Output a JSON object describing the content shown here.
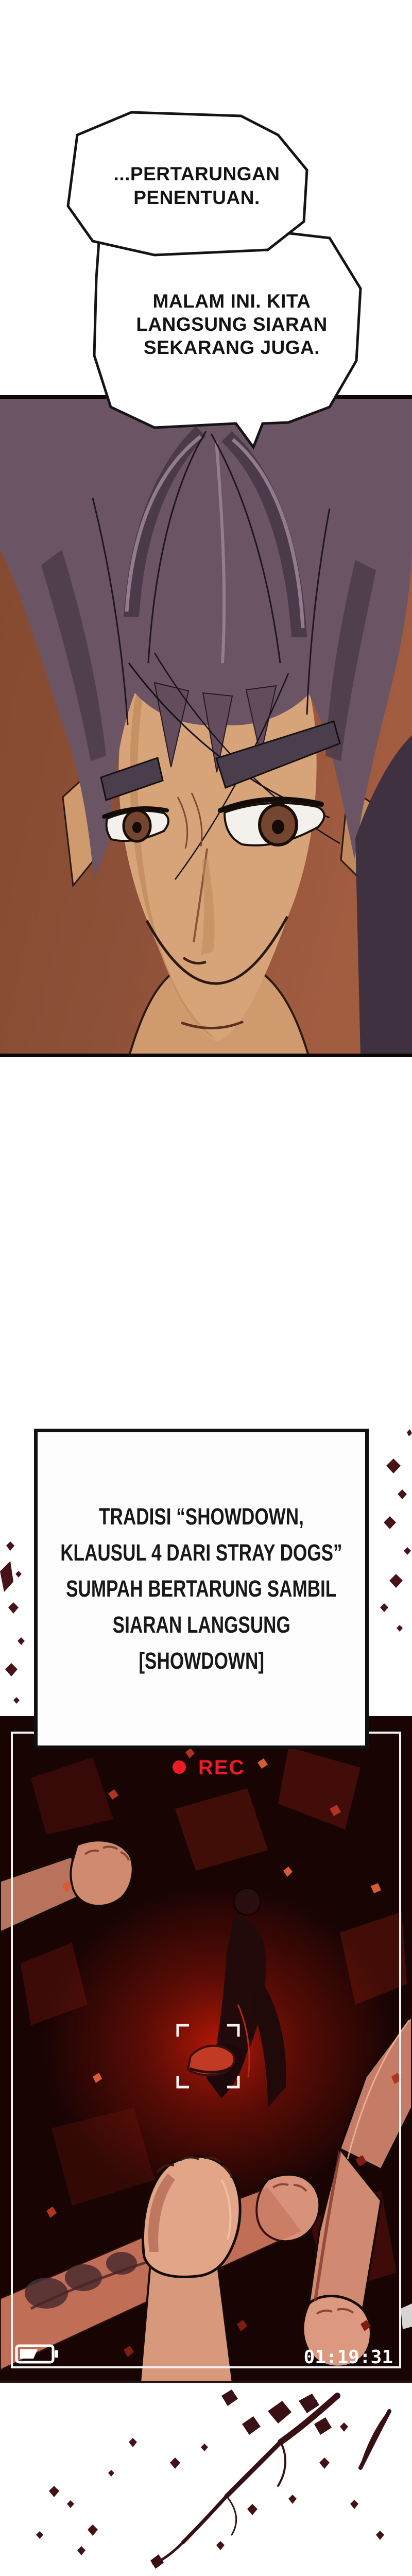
{
  "page": {
    "kind": "comic-page",
    "background": "#ffffff"
  },
  "bubbles": [
    {
      "lines": [
        "...PERTARUNGAN",
        "PENENTUAN."
      ]
    },
    {
      "lines": [
        "MALAM INI. KITA",
        "LANGSUNG SIARAN",
        "SEKARANG JUGA."
      ]
    }
  ],
  "info_box": {
    "lines": [
      "TRADISI “SHOWDOWN,",
      "KLAUSUL 4 DARI STRAY DOGS”",
      "SUMPAH BERTARUNG SAMBIL",
      "SIARAN LANGSUNG",
      "[SHOWDOWN]"
    ]
  },
  "camera": {
    "rec_label": "REC",
    "rec_color": "#ed1c24",
    "timestamp": "01:19:31",
    "timestamp_color": "#ffffff",
    "battery_level": "half",
    "frame_color": "#f2f2f2"
  },
  "colors": {
    "blood": "#3a1014",
    "panel_bg": "#190404",
    "hair": "#6b5463",
    "skin": "#d6a478",
    "backdrop_brown": "#8d5038"
  }
}
